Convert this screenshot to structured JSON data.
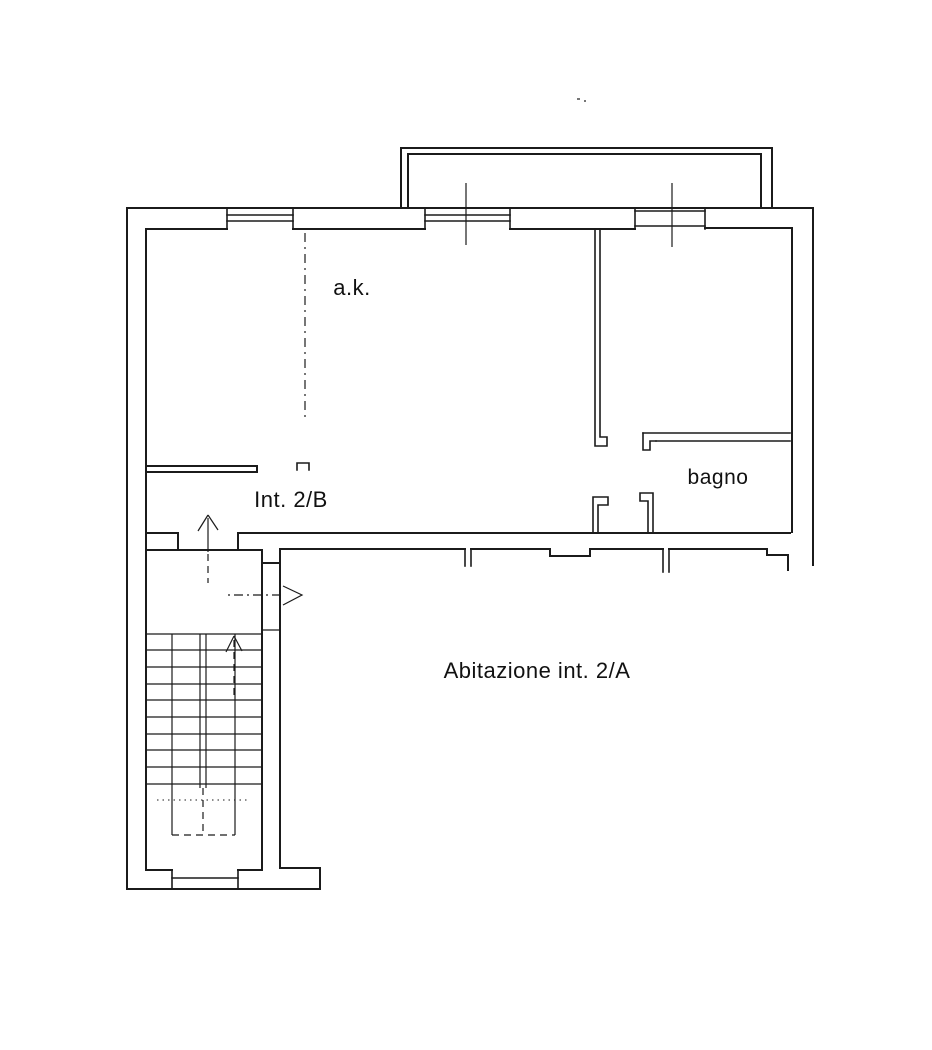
{
  "labels": {
    "room_ak": "a.k.",
    "unit_2b": "Int. 2/B",
    "bathroom": "bagno",
    "dwelling_2a": "Abitazione int. 2/A"
  },
  "colors": {
    "background": "#ffffff",
    "line": "#1b1b1b",
    "text": "#111111"
  }
}
